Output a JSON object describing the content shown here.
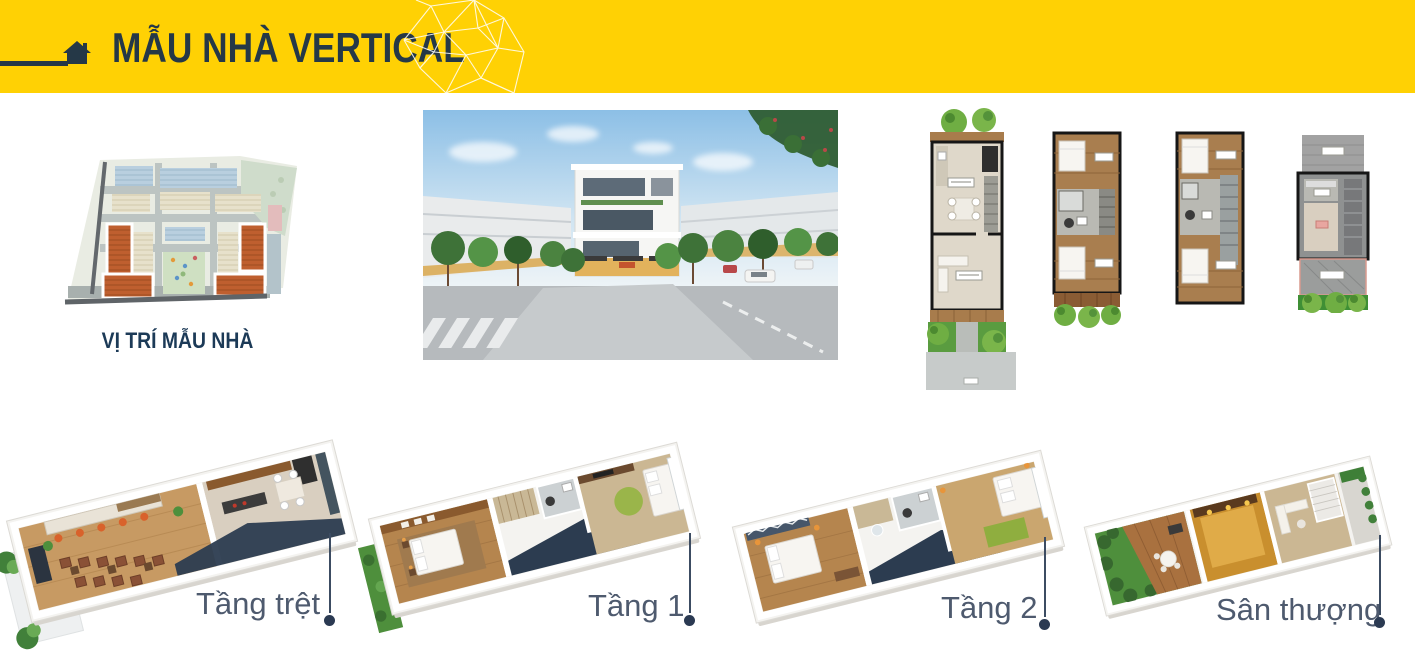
{
  "header": {
    "title": "MẪU NHÀ VERTICAL"
  },
  "site_plan": {
    "caption": "VỊ TRÍ MẪU NHÀ"
  },
  "floors": [
    {
      "label": "Tầng trệt"
    },
    {
      "label": "Tầng 1"
    },
    {
      "label": "Tầng 2"
    },
    {
      "label": "Sân thượng"
    }
  ],
  "colors": {
    "banner_yellow": "#FFD104",
    "title_navy": "#253847",
    "caption_navy": "#1C3A57",
    "floor_label_slate": "#4E5A6E",
    "marker_navy": "#2B3A52",
    "site_highlight_orange": "#BF5F2F"
  }
}
